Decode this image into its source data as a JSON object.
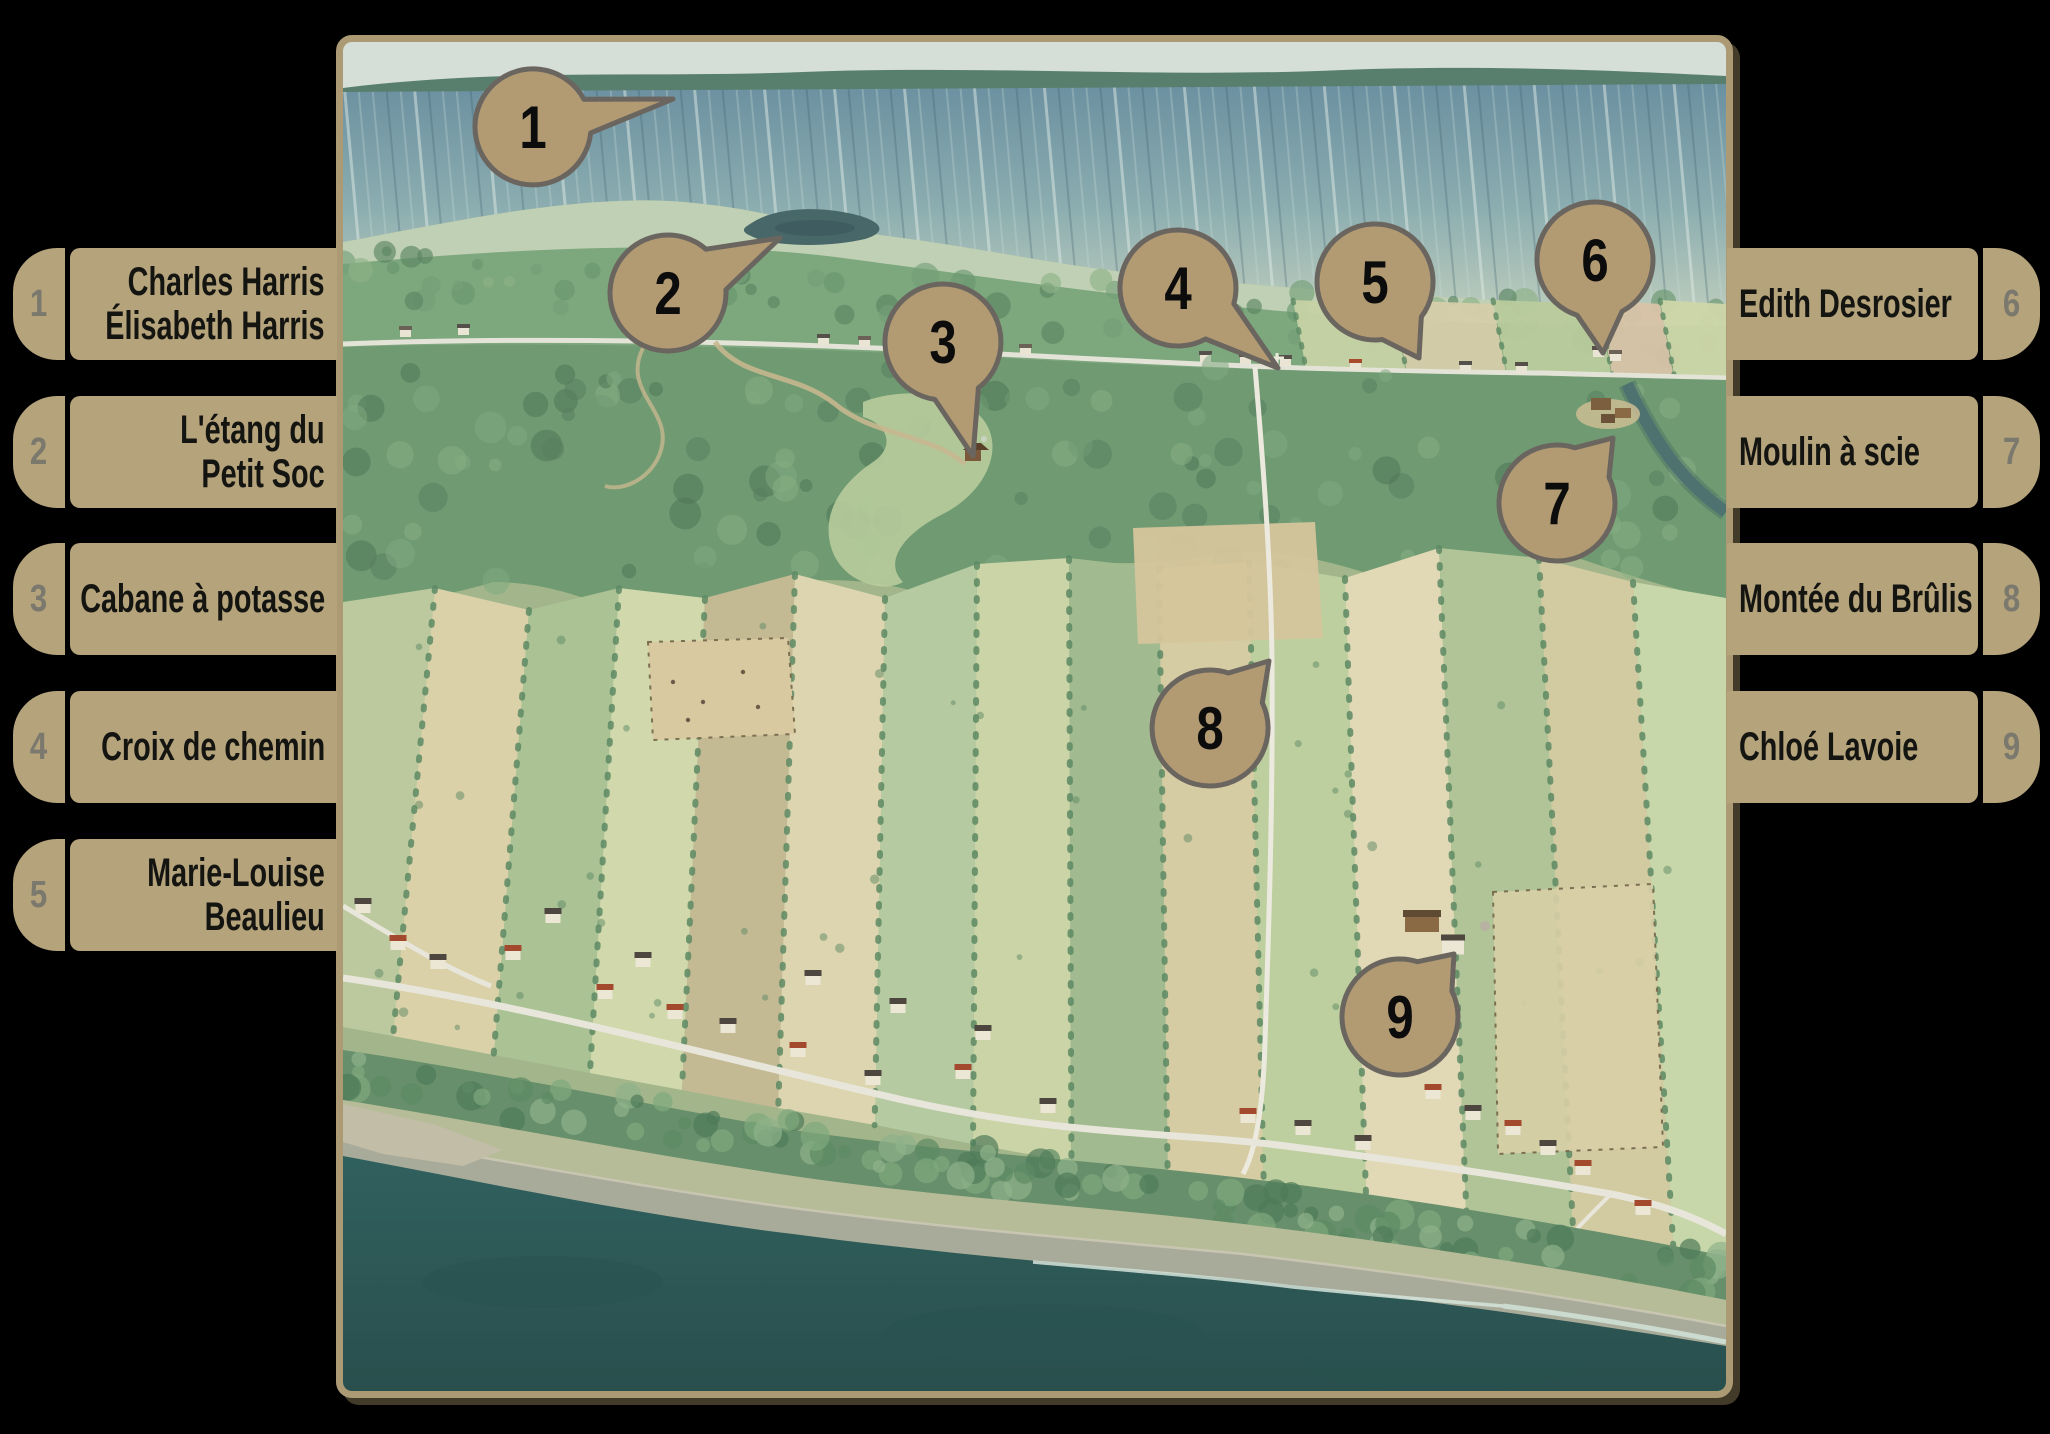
{
  "colors": {
    "background": "#000000",
    "panel_tan": "#b4a37b",
    "marker_fill": "#b29b72",
    "marker_outline": "#6b6560",
    "number_grey": "#7b796d",
    "text_black": "#141411",
    "map_frame": "#ab9a74",
    "water": "#2e5b59"
  },
  "legend_left": [
    {
      "number": "1",
      "line1": "Charles Harris",
      "line2": "Élisabeth Harris"
    },
    {
      "number": "2",
      "line1": "L'étang du",
      "line2": "Petit Soc"
    },
    {
      "number": "3",
      "line1": "Cabane à potasse"
    },
    {
      "number": "4",
      "line1": "Croix de chemin"
    },
    {
      "number": "5",
      "line1": "Marie-Louise",
      "line2": "Beaulieu"
    }
  ],
  "legend_right": [
    {
      "number": "6",
      "line1": "Edith Desrosier"
    },
    {
      "number": "7",
      "line1": "Moulin à scie"
    },
    {
      "number": "8",
      "line1": "Montée du Brûlis"
    },
    {
      "number": "9",
      "line1": "Chloé Lavoie"
    }
  ],
  "map_markers": [
    {
      "number": "1",
      "cx": 190,
      "cy": 85,
      "tipx": 330,
      "tipy": 57,
      "spread": 0.3
    },
    {
      "number": "2",
      "cx": 325,
      "cy": 251,
      "tipx": 437,
      "tipy": 196,
      "spread": 0.4
    },
    {
      "number": "3",
      "cx": 600,
      "cy": 300,
      "tipx": 630,
      "tipy": 414,
      "spread": 0.4
    },
    {
      "number": "4",
      "cx": 835,
      "cy": 246,
      "tipx": 935,
      "tipy": 326,
      "spread": 0.4
    },
    {
      "number": "5",
      "cx": 1032,
      "cy": 240,
      "tipx": 1076,
      "tipy": 316,
      "spread": 0.4
    },
    {
      "number": "6",
      "cx": 1252,
      "cy": 218,
      "tipx": 1260,
      "tipy": 311,
      "spread": 0.4
    },
    {
      "number": "7",
      "cx": 1214,
      "cy": 461,
      "tipx": 1270,
      "tipy": 396,
      "spread": 0.4
    },
    {
      "number": "8",
      "cx": 867,
      "cy": 686,
      "tipx": 926,
      "tipy": 619,
      "spread": 0.4
    },
    {
      "number": "9",
      "cx": 1057,
      "cy": 975,
      "tipx": 1111,
      "tipy": 912,
      "spread": 0.4
    }
  ]
}
